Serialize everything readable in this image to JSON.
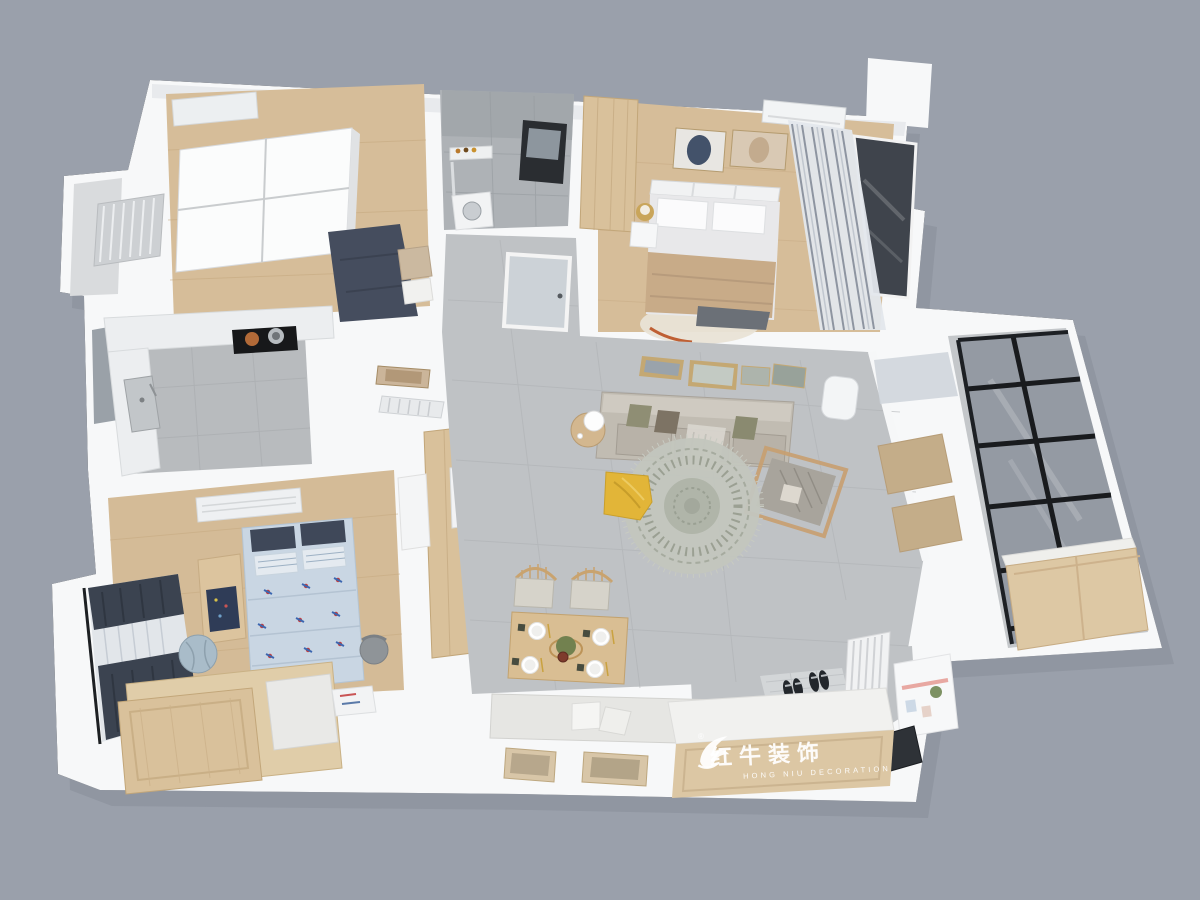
{
  "scene": {
    "type": "3d-apartment-floorplan-render",
    "view": "top-down isometric interior render",
    "background_color": "#9aa0ab",
    "rooms": [
      {
        "id": "second-bedroom",
        "furniture": [
          "sliding-door-wardrobe",
          "wall-air-conditioner",
          "double-bed-navy-bedding"
        ]
      },
      {
        "id": "side-balcony",
        "furniture": [
          "radiator"
        ]
      },
      {
        "id": "bathroom",
        "furniture": [
          "shower-set",
          "black-frame-mirror",
          "washing-machine"
        ]
      },
      {
        "id": "master-bedroom",
        "furniture": [
          "wood-wardrobe",
          "double-bed-tan-blanket",
          "nightstand-with-lamp",
          "two-wall-artworks",
          "wall-air-conditioner",
          "striped-curtains",
          "bay-window",
          "cream-rug"
        ]
      },
      {
        "id": "kitchen",
        "furniture": [
          "marble-l-counter",
          "cooktop-with-pots",
          "sink",
          "tall-pantry-with-fridge"
        ]
      },
      {
        "id": "hallway",
        "furniture": [
          "frosted-glass-door",
          "wall-art",
          "radiator"
        ]
      },
      {
        "id": "living-room",
        "furniture": [
          "gallery-wall-frames",
          "gray-sofa-with-pillows",
          "side-table-lamp",
          "floor-standing-ac",
          "wood-armchair",
          "round-mandala-rug",
          "yellow-beanbag"
        ]
      },
      {
        "id": "balcony",
        "furniture": [
          "glass-partition",
          "black-frame-glazing",
          "wood-cabinet"
        ]
      },
      {
        "id": "kids-bedroom",
        "furniture": [
          "wall-air-conditioner",
          "airplane-print-bed",
          "navy-curtains",
          "desk-globe",
          "toy-bin",
          "wood-platform-wardrobe",
          "desk-chair"
        ]
      },
      {
        "id": "dining-area",
        "furniture": [
          "wood-table-four-settings",
          "two-windsor-chairs",
          "banquette-with-pillows",
          "two-wall-frames"
        ]
      },
      {
        "id": "entry",
        "furniture": [
          "shoe-cabinet-bench",
          "slippers",
          "radiator",
          "pegboard-shelf",
          "dark-door-mat"
        ]
      }
    ]
  },
  "watermark": {
    "logo": "bull-swoosh-logo",
    "registered": "®",
    "brand_cn": "红牛装饰",
    "brand_en": "HONG NIU DECORATION",
    "text_color": "#ffffff"
  },
  "palette": {
    "background": "#9aa0ab",
    "walls": "#f7f8f9",
    "wood_floor": "#d6bd99",
    "gray_tile": "#bfc2c5",
    "navy_bedding": "#3f4757",
    "tan_blanket": "#c8ab88",
    "kids_bedding": "#c9d6e3",
    "yellow_beanbag": "#e2b538",
    "sofa_gray": "#c1bcb2",
    "wood_furniture": "#d9c19b",
    "window_frame_black": "#191b1e",
    "balcony_glass": "#8f96a0"
  }
}
